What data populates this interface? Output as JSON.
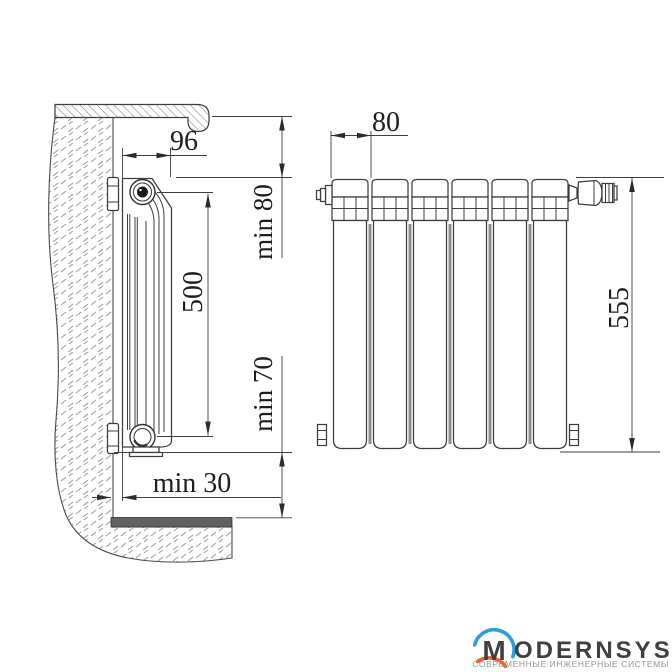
{
  "drawing": {
    "line_color": "#3d3d3d",
    "side_view": {
      "dimensions": {
        "depth": "96",
        "top_clearance": "min 80",
        "axis_height": "500",
        "bottom_clearance": "min 70",
        "wall_gap": "min 30"
      }
    },
    "front_view": {
      "section_count": 6,
      "dimensions": {
        "section_pitch": "80",
        "overall_height": "555"
      }
    }
  },
  "logo": {
    "brand_initial": "M",
    "brand_rest": "ODERNSYS",
    "subtitle": "СОВРЕМЕННЫЕ ИНЖЕНЕРНЫЕ СИСТЕМЫ",
    "colors": {
      "arc_top": "#2b9fd9",
      "arc_bottom": "#ec6430",
      "brand_text": "#404040",
      "subtitle_text": "#959595"
    }
  }
}
